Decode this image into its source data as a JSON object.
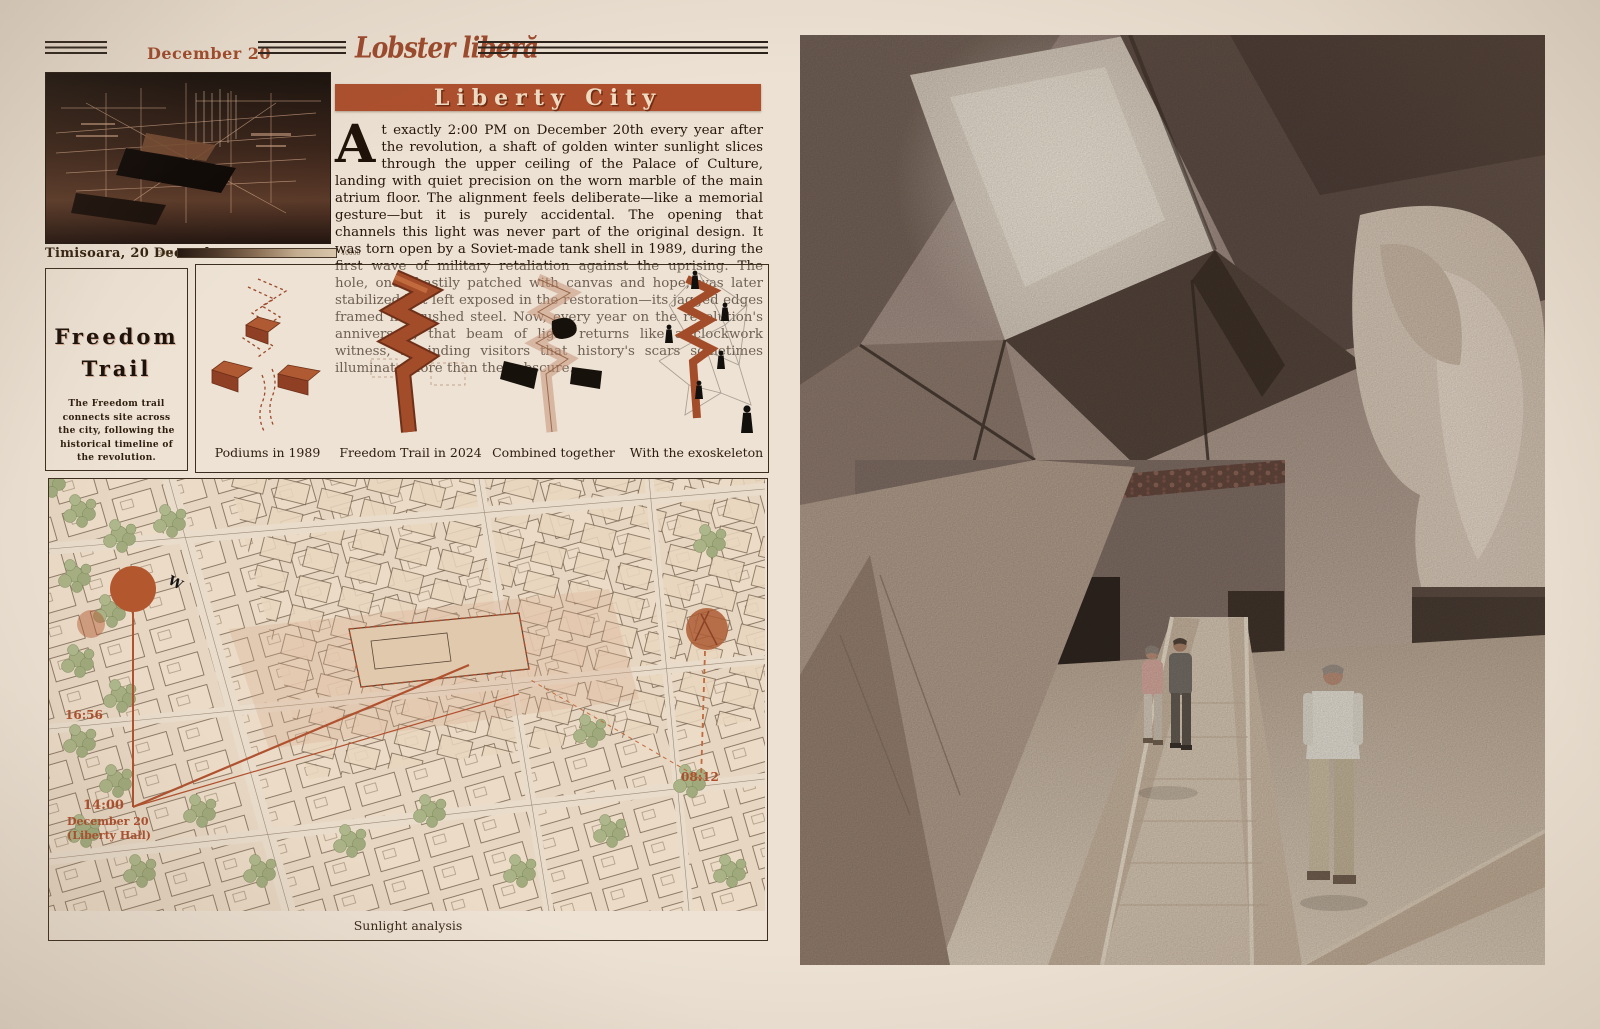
{
  "header": {
    "date": "December 20",
    "masthead": "Lobster liberă"
  },
  "article": {
    "headline": "Liberty City",
    "dropcap": "A",
    "body": "t exactly 2:00 PM on December 20th every year after the revolution, a shaft of golden winter sunlight slices through the upper ceiling of the Palace of Culture, landing with quiet precision on the worn marble of the main atrium floor. The alignment feels deliberate—like a memorial gesture—but it is purely accidental. The opening that channels this light was never part of the original design. It was torn open by a Soviet-made tank shell in 1989, during the first wave of military retaliation against the uprising. The hole, once hastily patched with canvas and hope, was later stabilized but left exposed in the restoration—its jagged edges framed in brushed steel. Now, every year on the revolution's anniversary, that beam of light returns like a clockwork witness, reminding visitors that history's scars sometimes illuminate more than they obscure."
  },
  "photo": {
    "caption": "Timisoara, 20 December",
    "scale_left": "5000",
    "scale_right": "40000"
  },
  "freedom_trail": {
    "title_line1": "Freedom",
    "title_line2": "Trail",
    "description": "The Freedom trail connects site across the city, following the historical timeline of the revolution."
  },
  "diagrams": {
    "captions": [
      "Podiums in 1989",
      "Freedom Trail in 2024",
      "Combined together",
      "With the exoskeleton"
    ]
  },
  "map": {
    "caption": "Sunlight analysis",
    "sunset_label": "16:56",
    "event_time": "14:00",
    "event_date": "December 20",
    "event_place": "(Liberty Hall)",
    "sunrise_label": "08:12",
    "compass_w": "W"
  },
  "colors": {
    "accent_rust": "#ad4f2d",
    "paper": "#ece1d3",
    "ink": "#2b1c10",
    "tree_green": "#a6af82"
  }
}
